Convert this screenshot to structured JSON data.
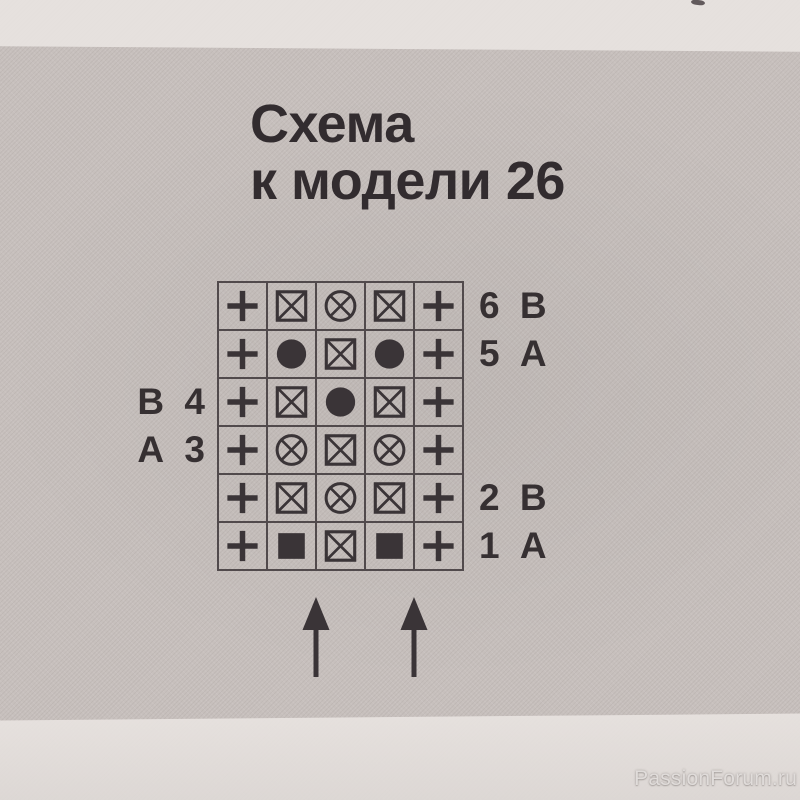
{
  "title": {
    "line1": "Схема",
    "line2": "к модели 26"
  },
  "chart": {
    "columns": 5,
    "rows": [
      {
        "row_number": "6",
        "yarn": "В",
        "left_label": "",
        "right_label": "6 В",
        "symbols": [
          "plus",
          "boxed_x",
          "circled_x",
          "boxed_x",
          "plus"
        ]
      },
      {
        "row_number": "5",
        "yarn": "А",
        "left_label": "",
        "right_label": "5 А",
        "symbols": [
          "plus",
          "dot",
          "boxed_x",
          "dot",
          "plus"
        ]
      },
      {
        "row_number": "4",
        "yarn": "В",
        "left_label": "В 4",
        "right_label": "",
        "symbols": [
          "plus",
          "boxed_x",
          "dot",
          "boxed_x",
          "plus"
        ]
      },
      {
        "row_number": "3",
        "yarn": "А",
        "left_label": "А 3",
        "right_label": "",
        "symbols": [
          "plus",
          "circled_x",
          "boxed_x",
          "circled_x",
          "plus"
        ]
      },
      {
        "row_number": "2",
        "yarn": "В",
        "left_label": "",
        "right_label": "2 В",
        "symbols": [
          "plus",
          "boxed_x",
          "circled_x",
          "boxed_x",
          "plus"
        ]
      },
      {
        "row_number": "1",
        "yarn": "А",
        "left_label": "",
        "right_label": "1 А",
        "symbols": [
          "plus",
          "filled_square",
          "boxed_x",
          "filled_square",
          "plus"
        ]
      }
    ],
    "arrows": {
      "count": 2,
      "direction": "up"
    }
  },
  "watermark": "PassionForum.ru",
  "colors": {
    "ink": "#3a3437",
    "line": "#514a4c",
    "paper": "#c7c0bd",
    "band": "#e9e4e1",
    "watermark_color": "#e0dcda"
  }
}
